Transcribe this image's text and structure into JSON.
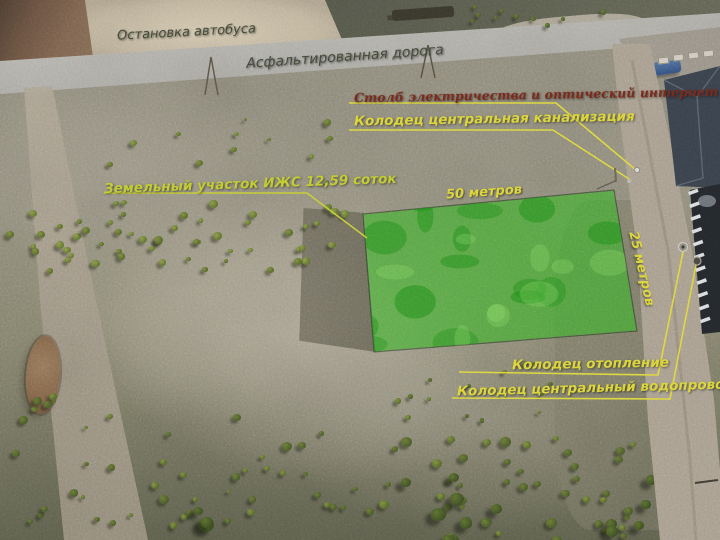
{
  "annotations": {
    "bus_stop": "Остановка автобуса",
    "asphalt_road": "Асфальтированная дорога",
    "power_internet": "Столб электричества и оптический интернет",
    "sewer_well": "Колодец центральная канализация",
    "plot_title": "Земельный участок ИЖС 12,59 соток",
    "width_label": "50 метров",
    "depth_label": "25 метров",
    "heating_well": "Колодец отопление",
    "water_well": "Колодец центральный водопровод"
  },
  "colors": {
    "plot_highlight": "#3ab329",
    "label_yellow": "#dcd63c",
    "label_yellow_green": "#c3cc34",
    "label_olive": "#464c3a",
    "label_maroon": "#7d2a1c"
  }
}
